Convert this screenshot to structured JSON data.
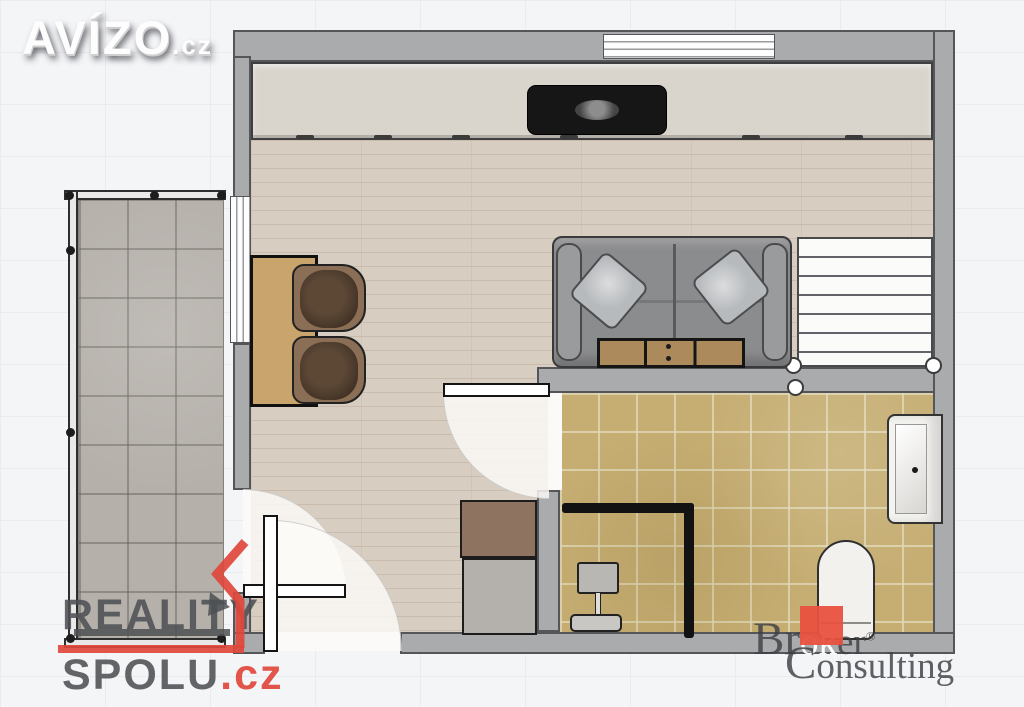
{
  "watermarks": {
    "avizo": {
      "text": "AVÍZO",
      "tld": ".cz"
    },
    "reality_spolu": {
      "line1": "REALITY",
      "line2": "SPOLU",
      "tld": ".cz",
      "accent_color": "#e0473c",
      "text_color": "#4e5054"
    },
    "broker": {
      "pre": "Br",
      "highlight": "ok",
      "post": "er",
      "reg": "®",
      "line2_cap": "C",
      "line2_rest": "onsulting",
      "accent_color": "#e8513e",
      "text_color": "#3e4044"
    }
  },
  "floorplan": {
    "colors": {
      "wall": "#a9abad",
      "wood_floor": "#d7cdc1",
      "bathroom_tile": "#c6ae73",
      "balcony_tile": "#b5b0aa",
      "top_cabinet": "#d9d4cc",
      "sofa": "#8b8c8e",
      "wood_furniture": "#c9a56d",
      "appliance_black": "#161616",
      "stairs": "#fbfbfa"
    }
  }
}
